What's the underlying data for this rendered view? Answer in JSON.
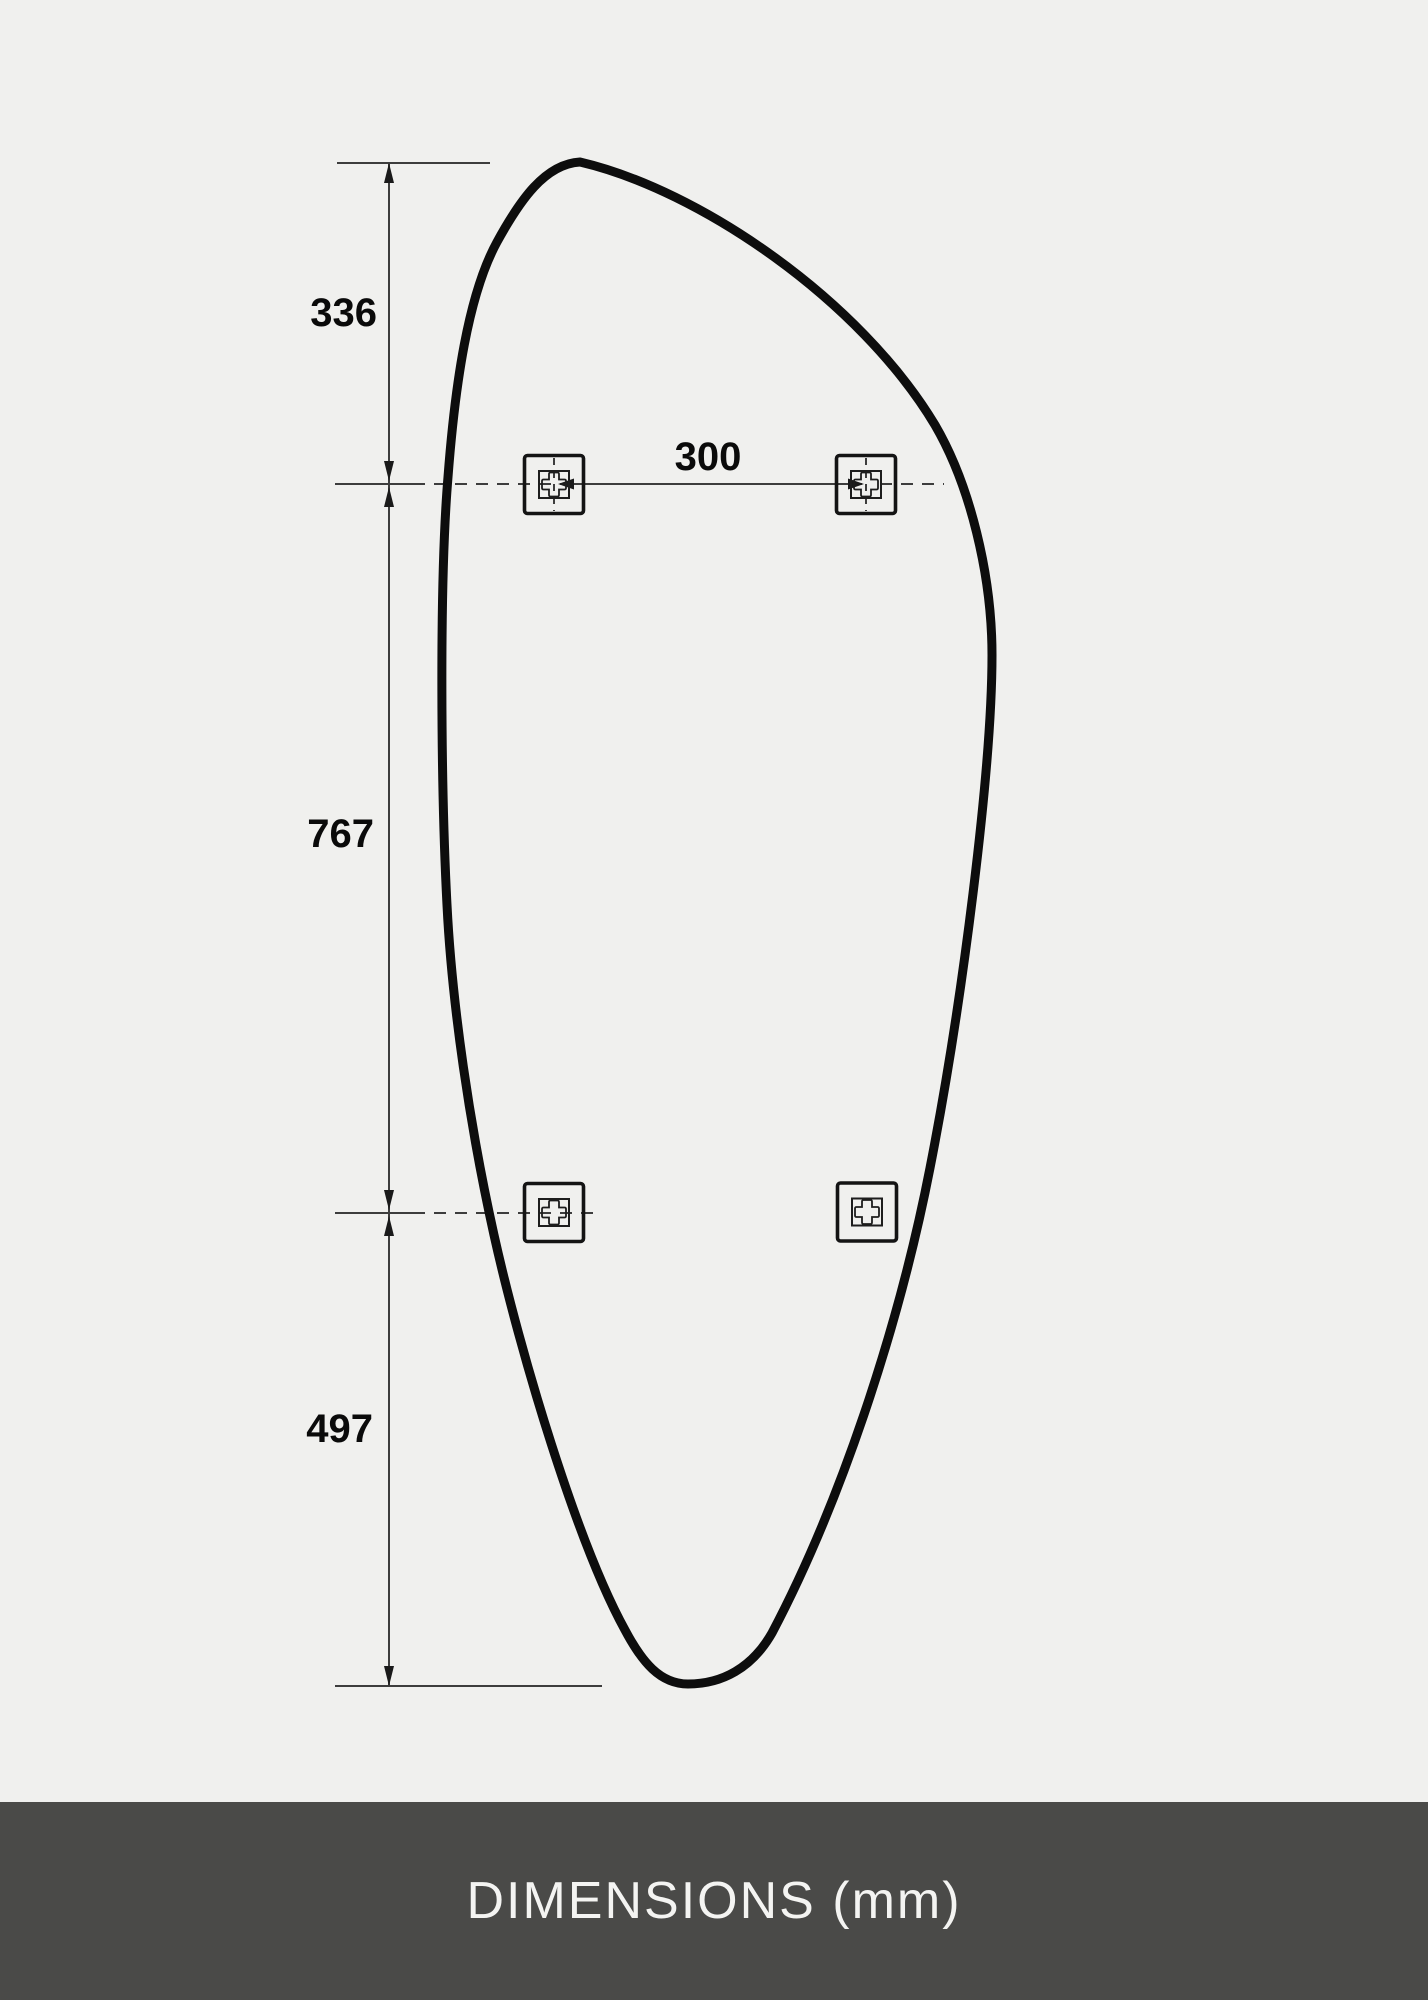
{
  "diagram": {
    "title_hint": "mounting dimension drawing of organic shaped mirror",
    "unit_labels": {
      "top_section": "336",
      "middle_section": "767",
      "bottom_section": "497",
      "bracket_spacing": "300"
    }
  },
  "footer": {
    "caption": "DIMENSIONS (mm)"
  },
  "colors": {
    "background": "#f0f0ee",
    "shape_outline": "#0d0d0d",
    "dimension_lines": "#3d3d3d",
    "label_text": "#0a0a0a",
    "footer_background": "#4a4a48",
    "footer_text": "#f4f4f2"
  }
}
